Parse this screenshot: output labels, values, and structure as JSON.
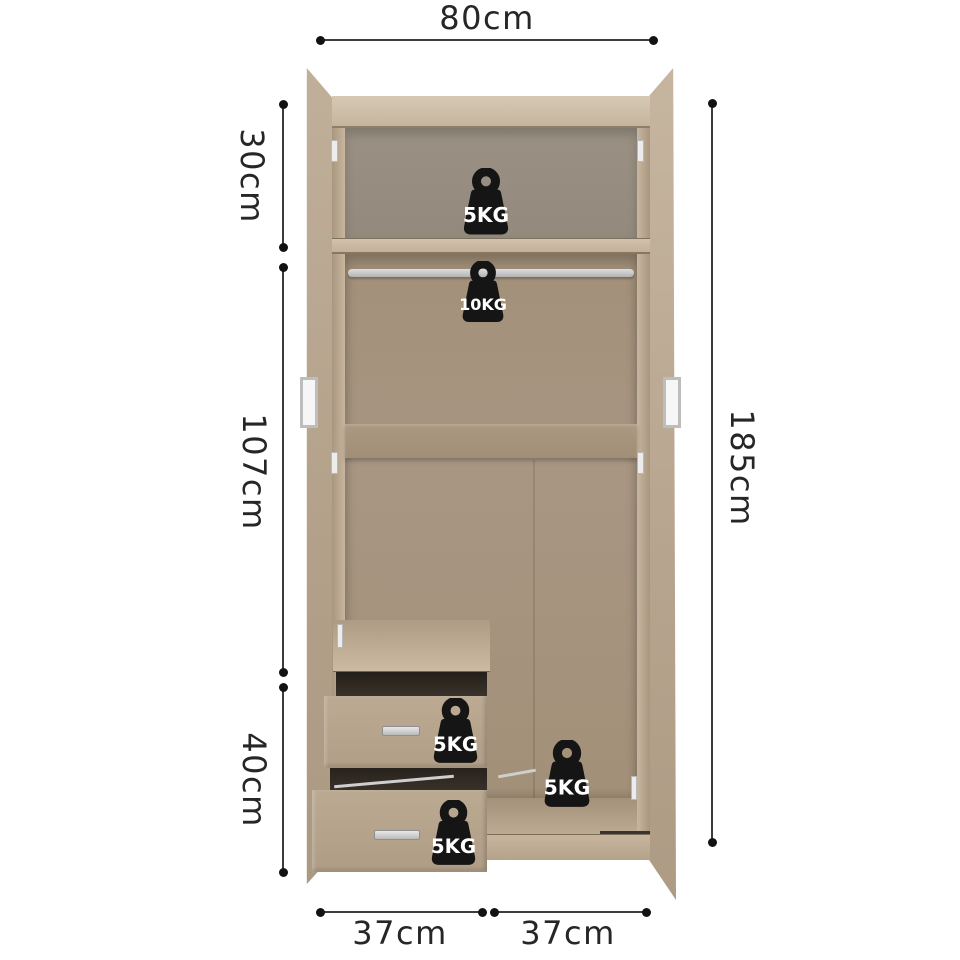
{
  "diagram": {
    "dimension_labels": {
      "top_width": "80cm",
      "upper_section_height": "30cm",
      "middle_section_height": "107cm",
      "lower_section_height": "40cm",
      "total_height": "185cm",
      "bottom_left_width": "37cm",
      "bottom_right_width": "37cm"
    },
    "load_capacities": [
      {
        "area": "top-shelf",
        "label": "5KG"
      },
      {
        "area": "hanging-rail",
        "label": "10KG"
      },
      {
        "area": "upper-drawer",
        "label": "5KG"
      },
      {
        "area": "lower-drawer",
        "label": "5KG"
      },
      {
        "area": "base-floor",
        "label": "5KG"
      }
    ],
    "icons": {
      "weight": "kettlebell-weight-icon"
    },
    "colors": {
      "background": "#ffffff",
      "dimension_line": "#3c3c3c",
      "dimension_text": "#262626",
      "wood_light": "#cdbca6",
      "wood_mid": "#b5a28c",
      "wood_dark": "#a08d77",
      "interior_back_upper": "#958c80",
      "interior_back": "#a69481",
      "gap_dark": "#332d26",
      "rail_silver": "#c9c9c9",
      "weight_fill": "#151515",
      "weight_text": "#ffffff"
    }
  }
}
